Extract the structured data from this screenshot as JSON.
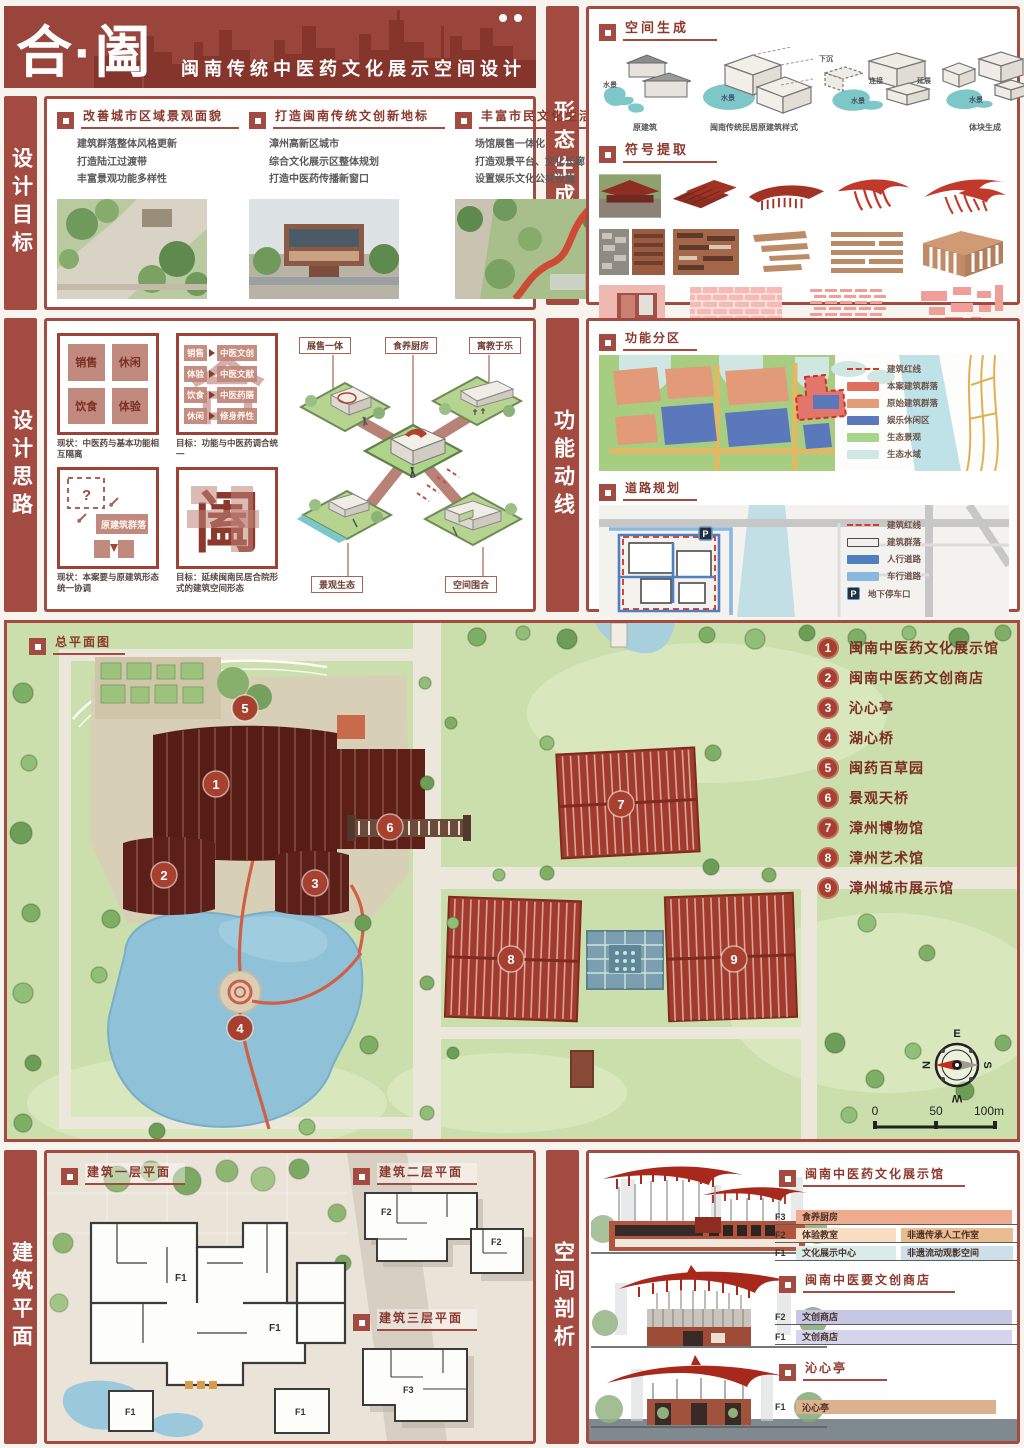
{
  "title": {
    "main": "合·阖",
    "sub": "闽南传统中医药文化展示空间设计"
  },
  "sidebars": {
    "goals": "设计目标",
    "thinking": "设计思路",
    "plans": "建筑平面",
    "form": "形态生成",
    "circulation": "功能动线",
    "analysis": "空间剖析"
  },
  "goals": {
    "columns": [
      {
        "title": "改善城市区域景观面貌",
        "bullets": [
          "建筑群落整体风格更新",
          "打造陆江过渡带",
          "丰富景观功能多样性"
        ]
      },
      {
        "title": "打造闽南传统文创新地标",
        "bullets": [
          "漳州高新区城市",
          "综合文化展示区整体规划",
          "打造中医药传播新窗口"
        ]
      },
      {
        "title": "丰富市民文化生活",
        "bullets": [
          "场馆展售一体化",
          "打造观景平台、文化长廊",
          "设置娱乐文化公共设施"
        ]
      }
    ]
  },
  "form": {
    "space_title": "空间生成",
    "symbol_title": "符号提取",
    "water_label": "水景",
    "steps": {
      "s1_caption": "原建筑",
      "s2_caption": "闽南传统民居原建筑样式",
      "s3_sink": "下沉",
      "s3_link": "连接",
      "s3_extend": "延展",
      "s4_caption": "体块生成"
    }
  },
  "thinking": {
    "d1": {
      "q1": "销售",
      "q2": "休闲",
      "q3": "饮食",
      "q4": "体验",
      "caption": "现状：中医药与基本功能相互隔离"
    },
    "d2": {
      "bg": "合",
      "rows": [
        {
          "from": "销售",
          "to": "中医文创"
        },
        {
          "from": "体验",
          "to": "中医文献"
        },
        {
          "from": "饮食",
          "to": "中医药膳"
        },
        {
          "from": "休闲",
          "to": "修身养性"
        }
      ],
      "caption": "目标：功能与中医药调合统一"
    },
    "d3": {
      "q": "?",
      "box": "原建筑群落",
      "caption": "现状：本案要与原建筑形态统一协调"
    },
    "d4": {
      "bg": "阖",
      "caption": "目标：延续闽南民居合院形式的建筑空间形态"
    },
    "axon": {
      "l1": "展售一体",
      "l2": "食养厨房",
      "l3": "寓教于乐",
      "l4": "景观生态",
      "l5": "空间围合"
    }
  },
  "circulation": {
    "zoning_title": "功能分区",
    "zoning_legend": [
      "建筑红线",
      "本案建筑群落",
      "原始建筑群落",
      "娱乐休闲区",
      "生态景观",
      "生态水域"
    ],
    "road_title": "道路规划",
    "road_legend": [
      "建筑红线",
      "建筑群落",
      "人行道路",
      "车行道路",
      "地下停车口"
    ],
    "p_label": "P"
  },
  "master": {
    "title": "总平面图",
    "legend": [
      {
        "num": "1",
        "label": "闽南中医药文化展示馆"
      },
      {
        "num": "2",
        "label": "闽南中医药文创商店"
      },
      {
        "num": "3",
        "label": "沁心亭"
      },
      {
        "num": "4",
        "label": "湖心桥"
      },
      {
        "num": "5",
        "label": "闽药百草园"
      },
      {
        "num": "6",
        "label": "景观天桥"
      },
      {
        "num": "7",
        "label": "漳州博物馆"
      },
      {
        "num": "8",
        "label": "漳州艺术馆"
      },
      {
        "num": "9",
        "label": "漳州城市展示馆"
      }
    ],
    "compass": {
      "top": "E",
      "left": "N",
      "right": "S",
      "bottom": "W"
    },
    "scale": {
      "zero": "0",
      "mid": "50",
      "end": "100m"
    }
  },
  "plans": {
    "f1_title": "建筑一层平面",
    "f2_title": "建筑二层平面",
    "f3_title": "建筑三层平面",
    "f1": "F1",
    "f2": "F2",
    "f3": "F3"
  },
  "analysis": {
    "s1": {
      "title": "闽南中医药文化展示馆",
      "floors": [
        {
          "level": "F3",
          "name": "食养厨房",
          "extra": ""
        },
        {
          "level": "F2",
          "name": "体验教室",
          "extra": "非遗传承人工作室"
        },
        {
          "level": "F1",
          "name": "文化展示中心",
          "extra": "非遗流动观影空间"
        }
      ]
    },
    "s2": {
      "title": "闽南中医要文创商店",
      "floors": [
        {
          "level": "F2",
          "name": "文创商店"
        },
        {
          "level": "F1",
          "name": "文创商店"
        }
      ]
    },
    "s3": {
      "title": "沁心亭",
      "floors": [
        {
          "level": "F1",
          "name": "沁心亭"
        }
      ]
    }
  }
}
